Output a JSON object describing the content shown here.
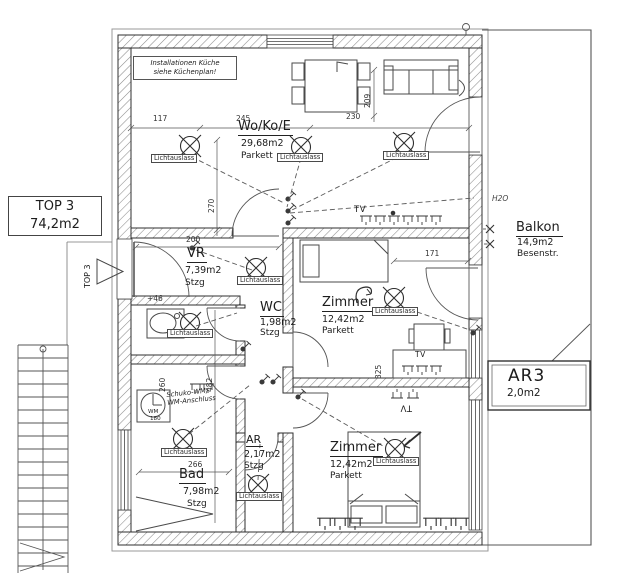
{
  "title_box": {
    "line1": "TOP 3",
    "line2": "74,2m2"
  },
  "entrance_marker": "TOP 3",
  "kitchen_note": {
    "line1": "Installationen Küche",
    "line2": "siehe Küchenplan!"
  },
  "rooms": {
    "wokoe": {
      "name": "Wo/Ko/E",
      "area": "29,68m2",
      "floor": "Parkett"
    },
    "vr": {
      "name": "VR",
      "area": "7,39m2",
      "floor": "Stzg"
    },
    "wc": {
      "name": "WC",
      "area": "1,98m2",
      "floor": "Stzg"
    },
    "zimmer1": {
      "name": "Zimmer",
      "area": "12,42m2",
      "floor": "Parkett"
    },
    "zimmer2": {
      "name": "Zimmer",
      "area": "12,42m2",
      "floor": "Parkett"
    },
    "bad": {
      "name": "Bad",
      "area": "7,98m2",
      "floor": "Stzg"
    },
    "ar": {
      "name": "AR",
      "area": "2,17m2",
      "floor": "Stzg"
    },
    "balkon": {
      "name": "Balkon",
      "area": "14,9m2",
      "note": "Besenstr."
    },
    "ar3": {
      "name": "AR3",
      "area": "2,0m2"
    }
  },
  "labels": {
    "lichtauslass": "Lichtauslass",
    "tv": "TV",
    "wm": "WM",
    "h2o": "H2O",
    "wm_note1": "Schuko-WM/",
    "wm_note2": "WM-Anschluss"
  },
  "dims": {
    "top_left": "117",
    "top_mid": "245",
    "top_right": "230",
    "sofa": "209",
    "vr_width": "200",
    "kitchen_h": "270",
    "zimmer1_w": "171",
    "bad_w_upper": "260",
    "hall_h": "482",
    "bad_w": "266",
    "wm_w": "180",
    "zimmer1_h": "325",
    "wc_level": "+46"
  }
}
